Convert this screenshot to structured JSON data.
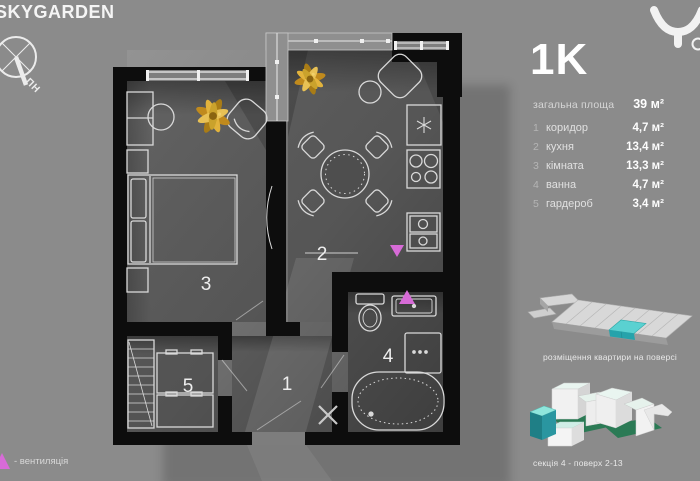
{
  "brand": {
    "name": "SKYGARDEN",
    "compass_north": "ПН"
  },
  "summary": {
    "unit_type": "1K",
    "total_area_label": "загальна площа",
    "total_area_value": "39 м²"
  },
  "rooms": [
    {
      "num": "1",
      "name": "коридор",
      "area": "4,7 м²"
    },
    {
      "num": "2",
      "name": "кухня",
      "area": "13,4 м²"
    },
    {
      "num": "3",
      "name": "кімната",
      "area": "13,3 м²"
    },
    {
      "num": "4",
      "name": "ванна",
      "area": "4,7 м²"
    },
    {
      "num": "5",
      "name": "гардероб",
      "area": "3,4 м²"
    }
  ],
  "plan": {
    "numbers": {
      "corridor": "1",
      "kitchen": "2",
      "bedroom": "3",
      "bath": "4",
      "wardrobe": "5"
    }
  },
  "diagrams": {
    "floor_caption": "розміщення квартири на поверсі",
    "section_caption": "секція 4 - поверх 2-13"
  },
  "legend": {
    "vent": "- вентиляція"
  },
  "colors": {
    "background": "#8b8b8b",
    "walls": "#0d0d0d",
    "accent_teal": "#3fc6c6",
    "vent_magenta": "#d76bd7",
    "plant_gold": "#c9982f",
    "roof_green": "#2b7a55"
  }
}
